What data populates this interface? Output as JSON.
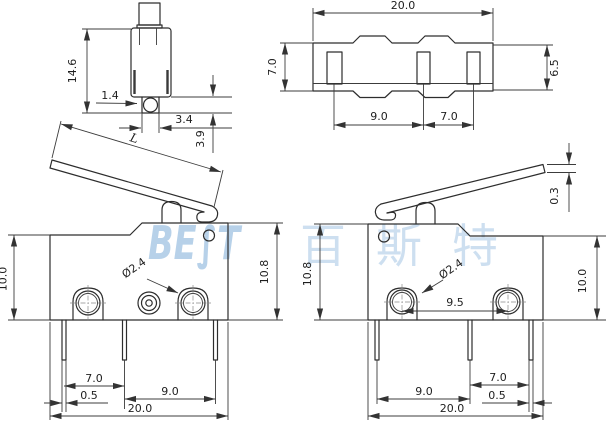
{
  "watermark": {
    "brand": "BE∫T",
    "brand_cn": "百斯特",
    "color": "#a6c6e4"
  },
  "views": {
    "side": {
      "body_height": "14.6",
      "hole_offset": "1.4",
      "boss_width": "3.4",
      "boss_height": "3.9"
    },
    "top": {
      "body_width": "20.0",
      "body_depth": "7.0",
      "cover_depth": "6.5",
      "slot_pitch_a": "9.0",
      "slot_pitch_b": "7.0"
    },
    "front_left": {
      "lever_length": "L",
      "height_front": "10.0",
      "height_back": "10.8",
      "hole_diameter": "Ø2.4",
      "pin_pitch_a": "7.0",
      "pin_inset": "0.5",
      "pin_pitch_b": "9.0",
      "body_width": "20.0"
    },
    "front_right": {
      "lever_tip_thickness": "0.3",
      "height_back": "10.8",
      "height_front": "10.0",
      "hole_diameter": "Ø2.4",
      "hole_pitch": "9.5",
      "pin_pitch_a": "9.0",
      "pin_pitch_b": "7.0",
      "pin_inset": "0.5",
      "body_width": "20.0"
    }
  }
}
